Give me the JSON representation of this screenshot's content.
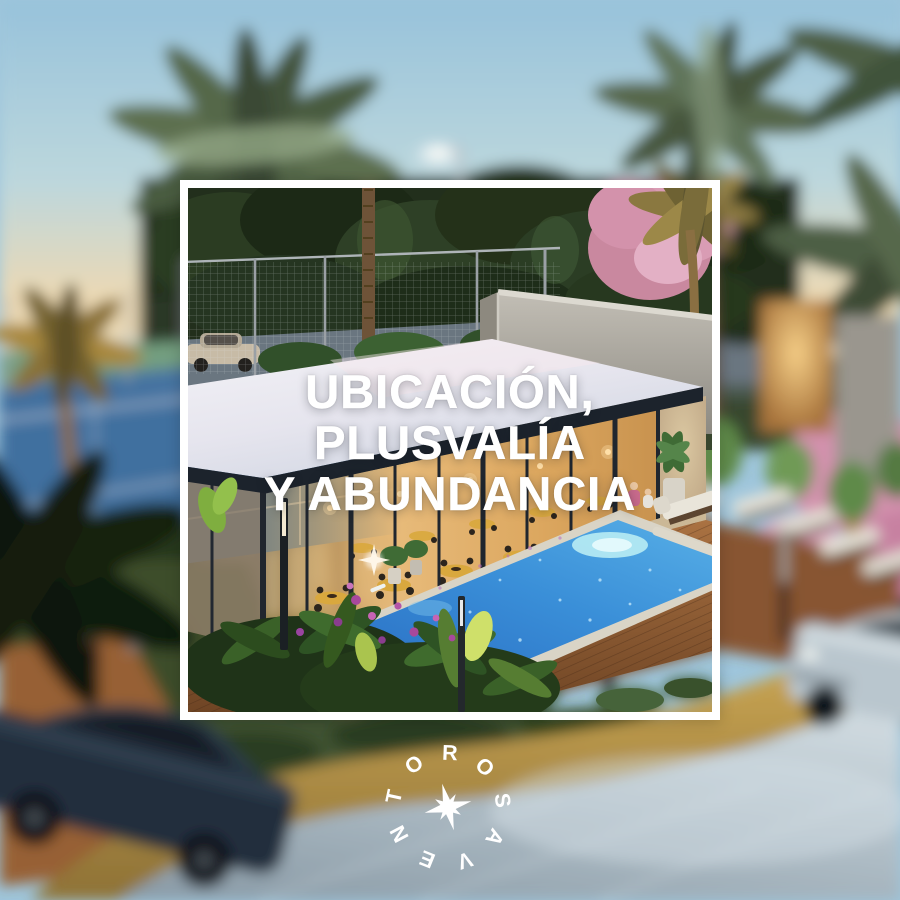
{
  "post": {
    "type": "real-estate-social-post",
    "headline": {
      "line1": "UBICACIÓN,",
      "line2": "PLUSVALÍA",
      "line3": "Y ABUNDANCIA"
    },
    "logo": {
      "name": "ROSAVENTO",
      "letters": [
        "R",
        "O",
        "S",
        "A",
        "V",
        "E",
        "N",
        "T",
        "O"
      ],
      "icon": "compass-star-icon"
    }
  },
  "scene": {
    "description": "Dusk 3D render of a residential amenity area seen from above; sharp inside a white frame, blurred outside",
    "elements": [
      "sunset-sky",
      "jungle-treeline",
      "palm-trees",
      "pink-flowering-trees",
      "padel-court",
      "fence",
      "parked-beige-car",
      "glass-clubhouse-restaurant",
      "white-flat-roof",
      "concrete-rooftop-volume",
      "swimming-pool",
      "spa",
      "wooden-deck",
      "tropical-garden",
      "sun-loungers",
      "street-lamp",
      "path-lights",
      "walking-person",
      "sand-path",
      "stone-road",
      "dark-car",
      "silver-car"
    ]
  },
  "colors": {
    "frame_border": "#ffffff",
    "headline_text": "#ffffff",
    "logo_text": "#ffffff",
    "sky_top": "#97c2da",
    "sunset_band": "#f6e2b2",
    "forest_dark": "#24321d",
    "court_blue": "#41719f",
    "court_green": "#7ba287",
    "roof_white": "#eef0f5",
    "fascia_dark": "#1c232c",
    "interior_glow": "#e0a966",
    "pool_water": "#2f86d4",
    "pool_light": "#b8ecf4",
    "deck_wood": "#94613a",
    "pink_tree": "#d79ab2",
    "lawn_green": "#3f5230",
    "path_gold": "#bd9c4c",
    "road_grey": "#9aa8b2",
    "car_dark": "#222e3c",
    "car_silver": "#b9c6ce"
  }
}
